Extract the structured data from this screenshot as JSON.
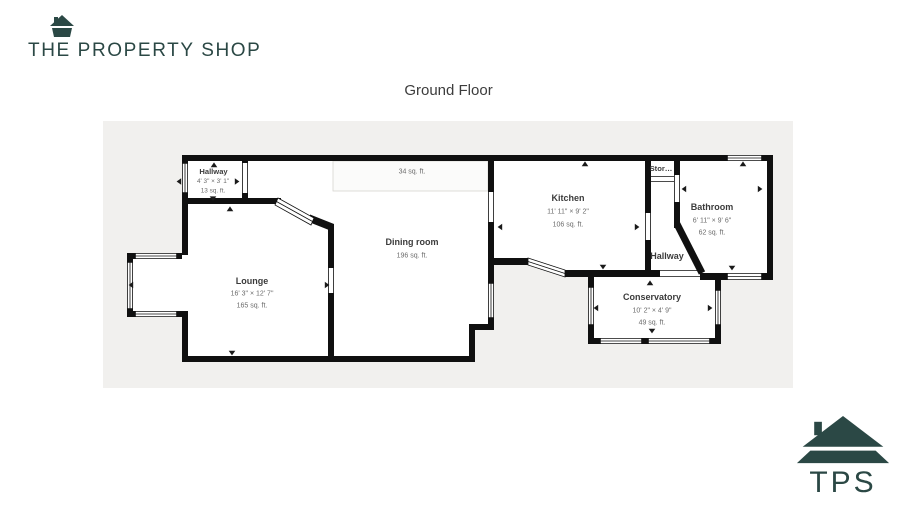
{
  "brand": {
    "logo_text": "THE PROPERTY SHOP",
    "badge_text": "TPS",
    "color": "#2b4845"
  },
  "page": {
    "title": "Ground Floor"
  },
  "plan": {
    "background": "#f1f0ee",
    "wall_color": "#101010",
    "rooms": {
      "hallway_front": {
        "name": "Hallway",
        "dims": "4' 3\" × 3' 1\"",
        "area": "13 sq. ft."
      },
      "lounge": {
        "name": "Lounge",
        "dims": "16' 3\" × 12' 7\"",
        "area": "165 sq. ft."
      },
      "dining": {
        "name": "Dining room",
        "area": "196 sq. ft."
      },
      "reduced_area": {
        "area": "34 sq. ft."
      },
      "kitchen": {
        "name": "Kitchen",
        "dims": "11' 11\" × 9' 2\"",
        "area": "106 sq. ft."
      },
      "storage": {
        "name": "Stor…"
      },
      "hallway_rear": {
        "name": "Hallway"
      },
      "bathroom": {
        "name": "Bathroom",
        "dims": "6' 11\" × 9' 6\"",
        "area": "62 sq. ft."
      },
      "conservatory": {
        "name": "Conservatory",
        "dims": "10' 2\" × 4' 9\"",
        "area": "49 sq. ft."
      }
    }
  }
}
